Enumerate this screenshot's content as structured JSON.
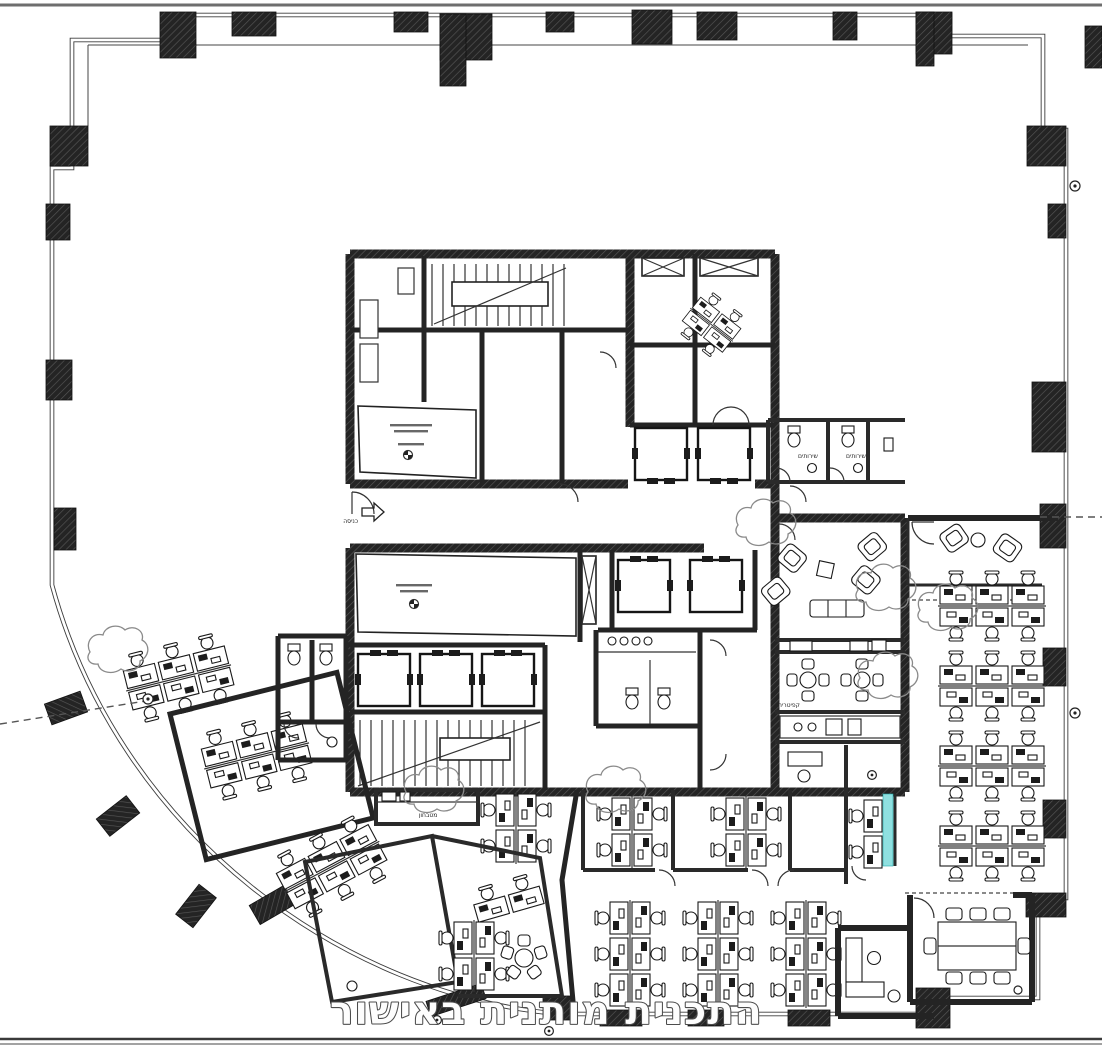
{
  "caption": {
    "text": "התכנית מותנית באישור"
  },
  "labels": {
    "entrance": "כניסה",
    "kitchenette": "מטבחון",
    "cafeteria": "קפיטריה",
    "toilets_1": "שירותים",
    "toilets_2": "שירותים"
  },
  "colors": {
    "wall": "#1f1f1f",
    "line": "#2a2a2a",
    "cloud_outline": "#8a8a8a",
    "glass_highlight": "#8fe0e0",
    "caption_fill": "#fdfdfd",
    "caption_outline": "#4c4c4c",
    "sheet_line": "#6e6e6e",
    "background": "#ffffff"
  },
  "furniture_summary": {
    "right_wing_desk_clusters": 4,
    "desks_per_right_cluster": 6,
    "bottom_open_clusters": 3,
    "left_wing_angled_clusters": 3,
    "private_office_clusters": 4,
    "cafeteria_tables": 2,
    "lounge_armchairs": 4,
    "reception_armchairs": 2,
    "conference_seats": 8,
    "elevators": 7,
    "stairwells": 2
  }
}
